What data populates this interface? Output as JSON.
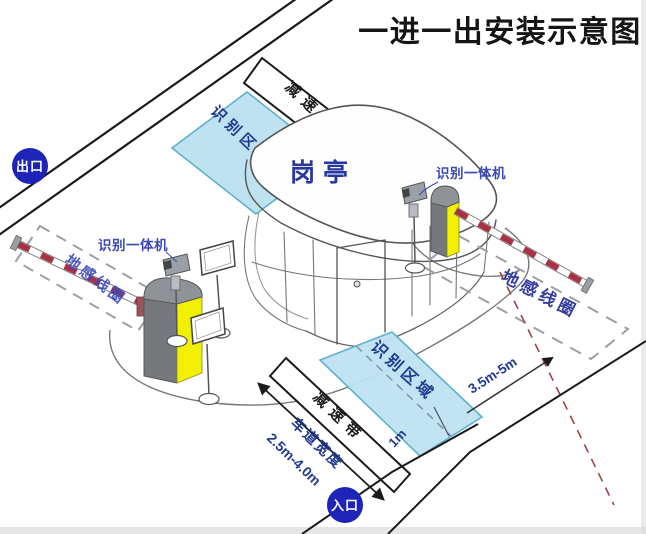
{
  "title": "一进一出安装示意图",
  "badges": {
    "exit": "出口",
    "entrance": "入口"
  },
  "booth": {
    "label": "岗亭"
  },
  "zones": {
    "top_label": "识别区域",
    "bottom_label": "识别区域"
  },
  "loops": {
    "left_label": "地感线圈",
    "right_label": "地感线圈"
  },
  "speed_bumps": {
    "top_label": "减速带",
    "bottom_label": "减速带"
  },
  "cameras": {
    "left_label": "识别一体机",
    "right_label": "识别一体机"
  },
  "measurements": {
    "loop_distance": "3.5m-5m",
    "zone_offset": "1m",
    "lane_width_label": "车道宽度",
    "lane_width_value": "2.5m-4.0m"
  },
  "colors": {
    "badge_blue": "#1e24b8",
    "zone_fill": "#bfe2f1",
    "zone_border": "#5fb0cb",
    "navy_text": "#27379f",
    "blue_label": "#3c49b8",
    "barrier_yellow": "#f3ef00",
    "barrier_gray": "#75797d",
    "arm_red": "#a83244",
    "dash_gray": "#9aa0a6",
    "dash_red": "#a04048",
    "line_black": "#1a1a1a"
  }
}
